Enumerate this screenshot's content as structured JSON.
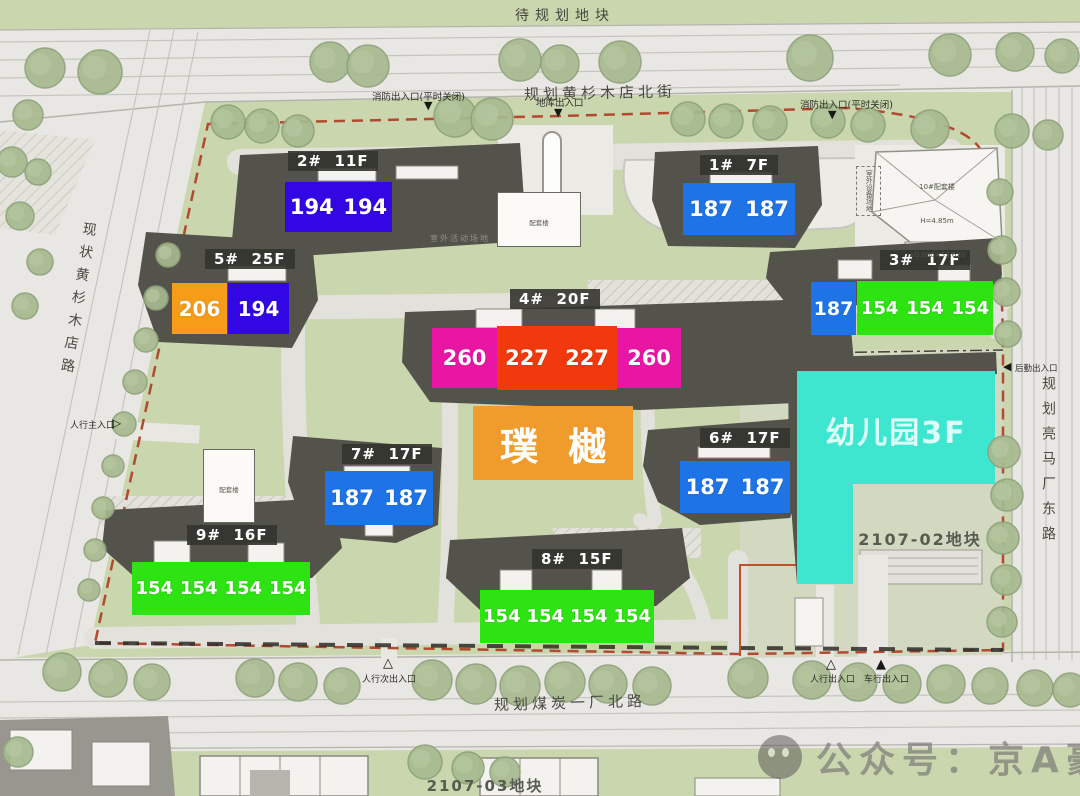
{
  "parcels": {
    "north": "待规划地块",
    "east": "2107-02地块",
    "south": "2107-03地块"
  },
  "roads": {
    "north": "规划黄杉木店北街",
    "west": "现状黄杉木店路",
    "east": "规划亮马厂东路",
    "south": "规划煤炭一厂北路"
  },
  "project": {
    "name": "璞樾",
    "kindergarten": "幼儿园3F"
  },
  "buildings": [
    {
      "id": "2#",
      "label": "2#  11F",
      "units": [
        "194",
        "194"
      ]
    },
    {
      "id": "1#",
      "label": "1#  7F",
      "units": [
        "187",
        "187"
      ]
    },
    {
      "id": "5#",
      "label": "5#  25F",
      "units": [
        "206",
        "194"
      ]
    },
    {
      "id": "4#",
      "label": "4#  20F",
      "units": [
        "260",
        "227",
        "227",
        "260"
      ]
    },
    {
      "id": "3#",
      "label": "3#  17F",
      "units": [
        "187",
        "154",
        "154",
        "154"
      ]
    },
    {
      "id": "7#",
      "label": "7#  17F",
      "units": [
        "187",
        "187"
      ]
    },
    {
      "id": "6#",
      "label": "6#  17F",
      "units": [
        "187",
        "187"
      ]
    },
    {
      "id": "9#",
      "label": "9#  16F",
      "units": [
        "154",
        "154",
        "154",
        "154"
      ]
    },
    {
      "id": "8#",
      "label": "8#  15F",
      "units": [
        "154",
        "154",
        "154",
        "154"
      ]
    }
  ],
  "entrances": {
    "fire_nw": "消防出入口(平时关闭)",
    "garage_n": "地库出入口",
    "fire_ne": "消防出入口(平时关闭)",
    "ped_main_w": "人行主入口",
    "logistics_e": "后勤出入口",
    "ped_sec_s": "人行次出入口",
    "ped_se": "人行出入口",
    "veh_se": "车行出入口"
  },
  "annotations": {
    "outdoor_equipment": "室外设备场地",
    "outdoor_activity": "室外活动场地",
    "aux_center_name": "配套楼",
    "aux_center_elev": "±0.000=33.630",
    "aux_10_name": "10#配套楼",
    "aux_10_height": "H=4.85m",
    "aux_10_elev": "±0.000=53.620",
    "aux_west_name": "配套楼"
  },
  "watermark": "公众号：京A豪宅",
  "colors": {
    "unit_194": "#3307e3",
    "unit_187": "#1e74e6",
    "unit_206": "#f59c18",
    "unit_260": "#e916a4",
    "unit_227": "#f2380d",
    "unit_154": "#2ee312",
    "kindergarten": "#3fe6cf",
    "brand": "#f09c2c",
    "boundary": "#b04a30",
    "site_green": "#cad6ae",
    "road_gray": "#e9e7e3"
  }
}
